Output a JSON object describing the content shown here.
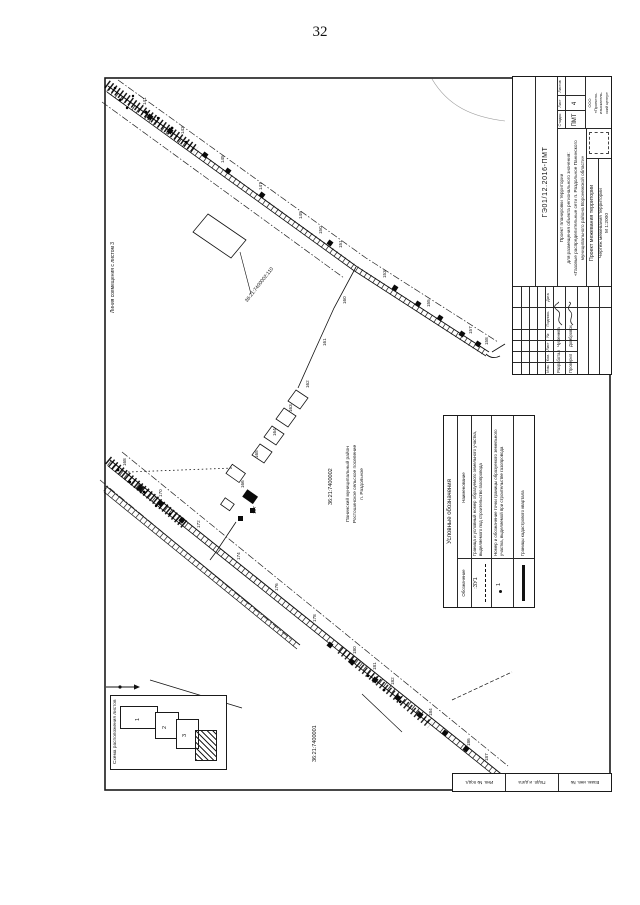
{
  "page": {
    "number": "32"
  },
  "stamp": {
    "doc_number": "ГЭ01/12.2016-ПМТ",
    "project_name_lines": [
      "Проект планировки территории",
      "для размещения объекта регионального значения:",
      "«Газовые распределительные сети п. Раздольное Панинского",
      "муниципального района Воронежской области»"
    ],
    "col_izm": "Изм.",
    "col_kol": "Кол.",
    "col_list": "Лист",
    "col_ndok": "№",
    "col_podpis": "Подпись",
    "col_data": "Дата",
    "row1_role": "Разработал",
    "row1_name": "Чуфенева",
    "row2_role": "Проверил",
    "row2_name": "Домбровская",
    "stage_label": "Стадия",
    "sheet_label": "Лист",
    "sheets_label": "Листов",
    "stage": "ПМТ",
    "sheet": "4",
    "sheets": "",
    "doc_type": "Проект межевания территории",
    "drawing_title": "Чертеж межевания территории",
    "scale": "М 1:2000",
    "organization_lines": [
      "ООО",
      "«Проектно-",
      "изыскатель-",
      "ский центр»"
    ]
  },
  "legend": {
    "title": "Условные обозначения",
    "col_designation": "Обозначение",
    "col_name": "Наименование",
    "row1_symbol": ":ЗУ1",
    "row1_text": "Граница и условный номер образуемого земельного участка, выделяемого под строительство газопровода",
    "row2_symbol": "1",
    "row2_text": "Номер и обозначение точки границы образуемого земельного участка, выделяемой при строительстве газопровода",
    "row3_text": "Границы кадастрового квартала"
  },
  "inset": {
    "title": "Схема расположения листов",
    "sheet_numbers": [
      "1",
      "2",
      "3"
    ]
  },
  "side_strip": {
    "cells": [
      "Взам. инв. №",
      "Подп. и дата",
      "Инв. № подл."
    ]
  },
  "map": {
    "edge_note": "Линия совмещения с листом 3",
    "cadastral_quarter_upper": "36:21:7400002",
    "cadastral_quarter_lower": "36:21:7400001",
    "parcel_label": "36:21:7400002:110",
    "settlement_lines": [
      "Панинский муниципальный район",
      "Ростошинское сельское поселение",
      "п. Раздольное"
    ],
    "point_labels": [
      {
        "t": "141",
        "x": 142,
        "y": 105
      },
      {
        "t": "143",
        "x": 180,
        "y": 134
      },
      {
        "t": "145",
        "x": 220,
        "y": 163
      },
      {
        "t": "147",
        "x": 258,
        "y": 190
      },
      {
        "t": "149",
        "x": 298,
        "y": 219
      },
      {
        "t": "150",
        "x": 318,
        "y": 234
      },
      {
        "t": "151",
        "x": 338,
        "y": 248
      },
      {
        "t": "153",
        "x": 382,
        "y": 278
      },
      {
        "t": "155",
        "x": 426,
        "y": 307
      },
      {
        "t": "157",
        "x": 468,
        "y": 334
      },
      {
        "t": "158",
        "x": 484,
        "y": 345
      },
      {
        "t": "160",
        "x": 342,
        "y": 304
      },
      {
        "t": "161",
        "x": 322,
        "y": 346
      },
      {
        "t": "162",
        "x": 305,
        "y": 388
      },
      {
        "t": "163",
        "x": 288,
        "y": 412
      },
      {
        "t": "164",
        "x": 272,
        "y": 436
      },
      {
        "t": "165",
        "x": 254,
        "y": 458
      },
      {
        "t": "166",
        "x": 240,
        "y": 488
      },
      {
        "t": "167",
        "x": 252,
        "y": 514
      },
      {
        "t": "168",
        "x": 122,
        "y": 466
      },
      {
        "t": "170",
        "x": 158,
        "y": 497
      },
      {
        "t": "172",
        "x": 196,
        "y": 528
      },
      {
        "t": "174",
        "x": 236,
        "y": 560
      },
      {
        "t": "176",
        "x": 274,
        "y": 591
      },
      {
        "t": "178",
        "x": 312,
        "y": 622
      },
      {
        "t": "180",
        "x": 352,
        "y": 654
      },
      {
        "t": "181",
        "x": 372,
        "y": 670
      },
      {
        "t": "182",
        "x": 390,
        "y": 685
      },
      {
        "t": "184",
        "x": 428,
        "y": 716
      },
      {
        "t": "186",
        "x": 466,
        "y": 746
      },
      {
        "t": "187",
        "x": 484,
        "y": 761
      }
    ]
  }
}
